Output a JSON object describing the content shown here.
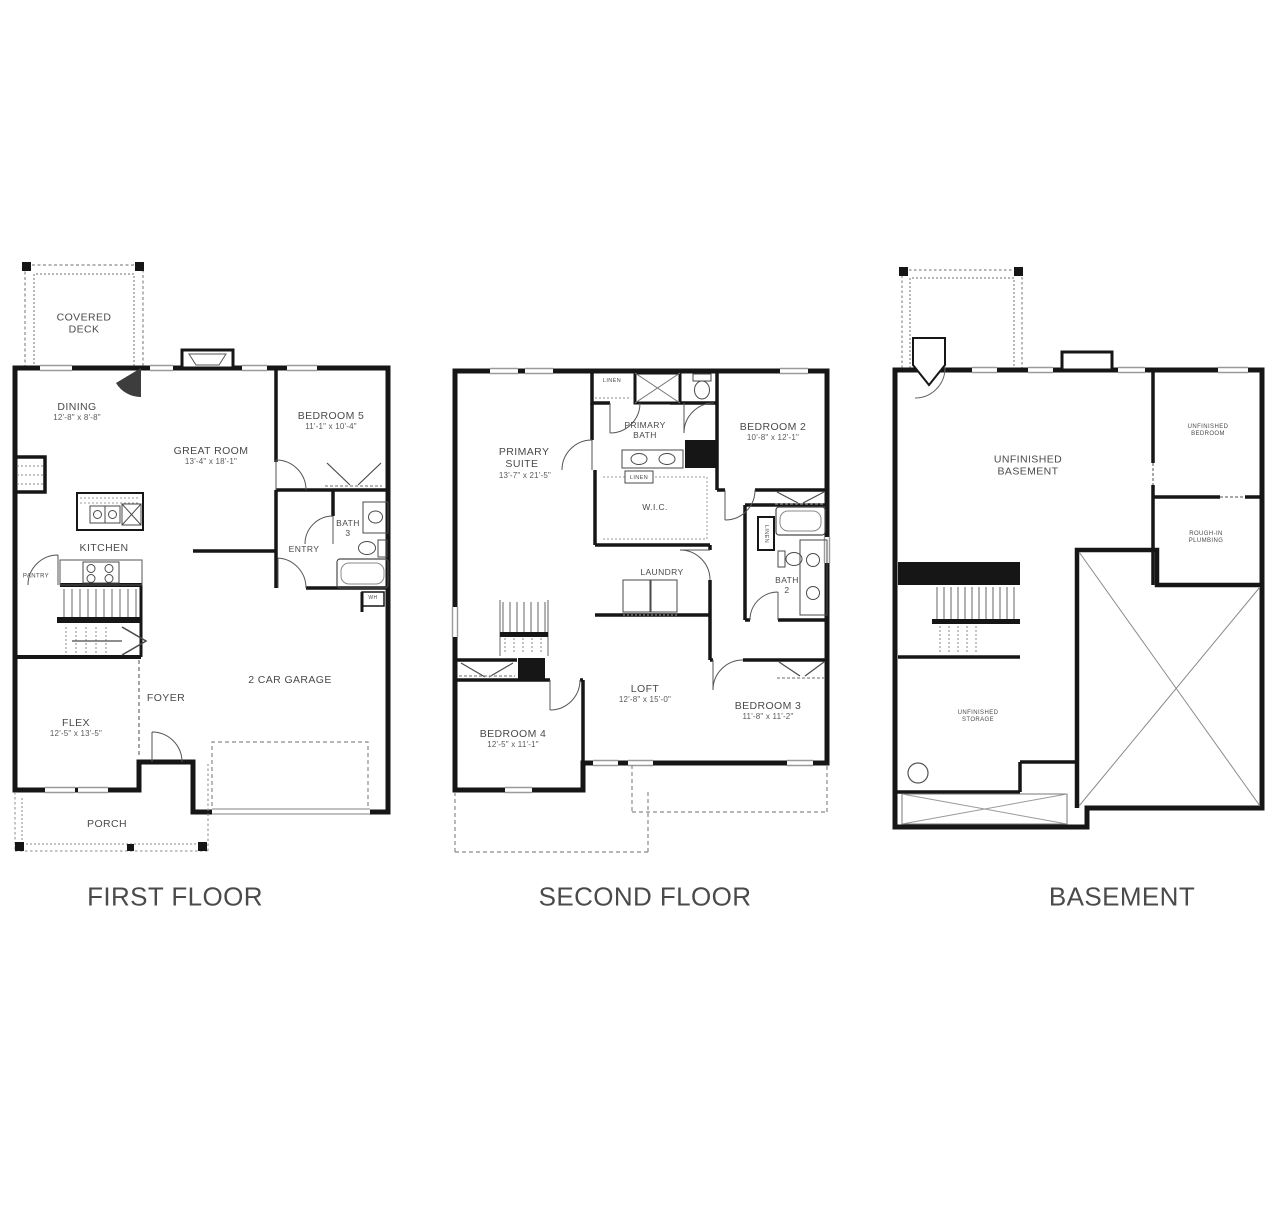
{
  "titles": {
    "first": "FIRST FLOOR",
    "second": "SECOND FLOOR",
    "basement": "BASEMENT"
  },
  "first_floor": {
    "covered_deck": "COVERED DECK",
    "dining": {
      "name": "DINING",
      "dims": "12'-8\" x 8'-8\""
    },
    "great_room": {
      "name": "GREAT ROOM",
      "dims": "13'-4\" x 18'-1\""
    },
    "bedroom5": {
      "name": "BEDROOM 5",
      "dims": "11'-1\" x 10'-4\""
    },
    "kitchen": "KITCHEN",
    "pantry": "PANTRY",
    "bath3": "BATH 3",
    "entry": "ENTRY",
    "garage": "2 CAR GARAGE",
    "flex": {
      "name": "FLEX",
      "dims": "12'-5\" x 13'-5\""
    },
    "foyer": "FOYER",
    "porch": "PORCH",
    "water_heater": "WH"
  },
  "second_floor": {
    "primary_suite": {
      "name": "PRIMARY SUITE",
      "dims": "13'-7\" x 21'-5\""
    },
    "primary_bath": "PRIMARY BATH",
    "bedroom2": {
      "name": "BEDROOM 2",
      "dims": "10'-8\" x 12'-1\""
    },
    "wic": "W.I.C.",
    "linen": "LINEN",
    "laundry": "LAUNDRY",
    "bath2": "BATH 2",
    "loft": {
      "name": "LOFT",
      "dims": "12'-8\" x 15'-0\""
    },
    "bedroom4": {
      "name": "BEDROOM 4",
      "dims": "12'-5\" x 11'-1\""
    },
    "bedroom3": {
      "name": "BEDROOM 3",
      "dims": "11'-8\" x 11'-2\""
    }
  },
  "basement": {
    "unfinished_basement": "UNFINISHED BASEMENT",
    "unfinished_bedroom": "UNFINISHED BEDROOM",
    "rough_in": "ROUGH-IN PLUMBING",
    "unfinished_storage": "UNFINISHED STORAGE"
  },
  "colors": {
    "wall": "#161616",
    "fixture": "#4a4a4a",
    "dash": "#8a8a8a",
    "window": "#9a9a9a"
  }
}
